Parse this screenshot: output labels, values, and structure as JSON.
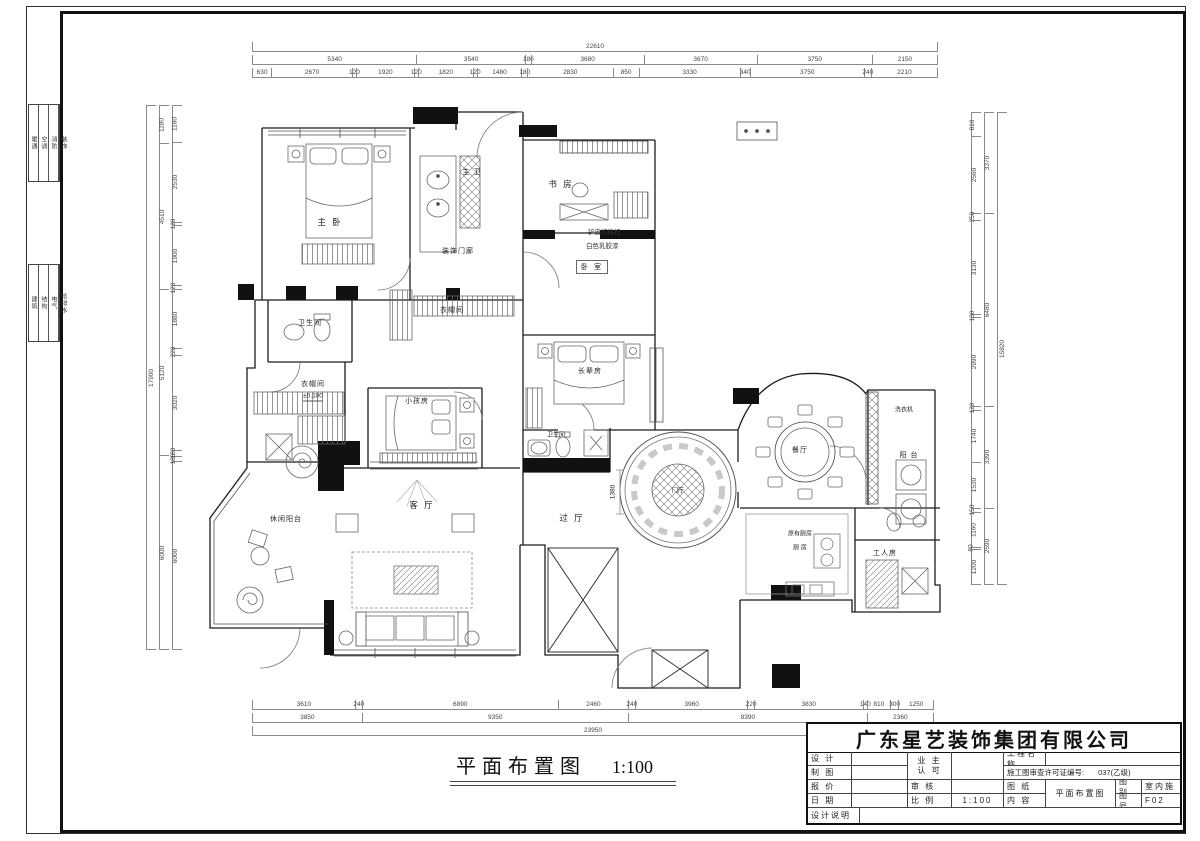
{
  "sheet": {
    "title": "平面布置图",
    "scale": "1:100"
  },
  "title_block": {
    "company": "广东星艺装饰集团有限公司",
    "design": "设 计",
    "draft": "制 图",
    "quote": "报 价",
    "date": "日 期",
    "notes": "设计说明",
    "owner1": "业 主",
    "owner2": "认 可",
    "audit": "审 核",
    "scale_label": "比 例",
    "scale_value": "1:100",
    "project": "工程名称",
    "permit_label": "施工图审查许可证编号:",
    "permit_value": "037(乙级)",
    "sheet_label": "图 纸",
    "content_label": "内 容",
    "content_value": "平面布置图",
    "cat_label": "图别",
    "cat_value": "室内施",
    "no_label": "图号",
    "no_value": "F02"
  },
  "side_strip": {
    "top": [
      "暖通",
      "空调",
      "消防",
      "装饰"
    ],
    "bottom": [
      "建筑",
      "结构",
      "电气",
      "给排水"
    ]
  },
  "rooms": [
    {
      "name": "主 卧"
    },
    {
      "name": "主 卫"
    },
    {
      "name": "书 房"
    },
    {
      "name": "卧 室"
    },
    {
      "name": "装饰门廊"
    },
    {
      "name": "衣帽间"
    },
    {
      "name": "卫生间"
    },
    {
      "name": "衣帽间"
    },
    {
      "name": "小孩房"
    },
    {
      "name": "长辈房"
    },
    {
      "name": "卫生间"
    },
    {
      "name": "客 厅"
    },
    {
      "name": "过 厅"
    },
    {
      "name": "门厅"
    },
    {
      "name": "餐厅"
    },
    {
      "name": "阳 台"
    },
    {
      "name": "原有厨房"
    },
    {
      "name": "厨 房"
    },
    {
      "name": "工人房"
    },
    {
      "name": "休闲阳台"
    }
  ],
  "annotations": {
    "paint1": "铲皮打底扫",
    "paint2": "白色乳胶漆",
    "level": "±0.100",
    "washer": "洗衣机",
    "dim_1380": "1380"
  },
  "dims": {
    "top": {
      "row1": [
        "22610"
      ],
      "row2": [
        "5340",
        "3540",
        "180",
        "3680",
        "3670",
        "3750",
        "2150"
      ],
      "row3": [
        "630",
        "2670",
        "120",
        "1920",
        "120",
        "1820",
        "120",
        "1480",
        "180",
        "2830",
        "850",
        "3330",
        "340",
        "3750",
        "240",
        "2210"
      ]
    },
    "bottom": {
      "row1": [
        "3610",
        "240",
        "6890",
        "2460",
        "240",
        "3960",
        "220",
        "3830",
        "140",
        "810",
        "300",
        "1250"
      ],
      "row2": [
        "3850",
        "9350",
        "8390",
        "2360"
      ],
      "row3": [
        "23950"
      ]
    },
    "left": {
      "outer": [
        "17900"
      ],
      "mid": [
        "1180",
        "4510",
        "5120",
        "6000"
      ],
      "inner": [
        "1180",
        "2530",
        "120",
        "1900",
        "120",
        "1880",
        "220",
        "3020",
        "180",
        "180",
        "6000"
      ]
    },
    "right": {
      "inner": [
        "810",
        "2560",
        "250",
        "3130",
        "100",
        "2990",
        "120",
        "1740",
        "1530",
        "150",
        "1160",
        "80",
        "1200"
      ],
      "mid": [
        "3370",
        "6480",
        "3390",
        "2590"
      ],
      "outer": [
        "15820"
      ]
    }
  }
}
